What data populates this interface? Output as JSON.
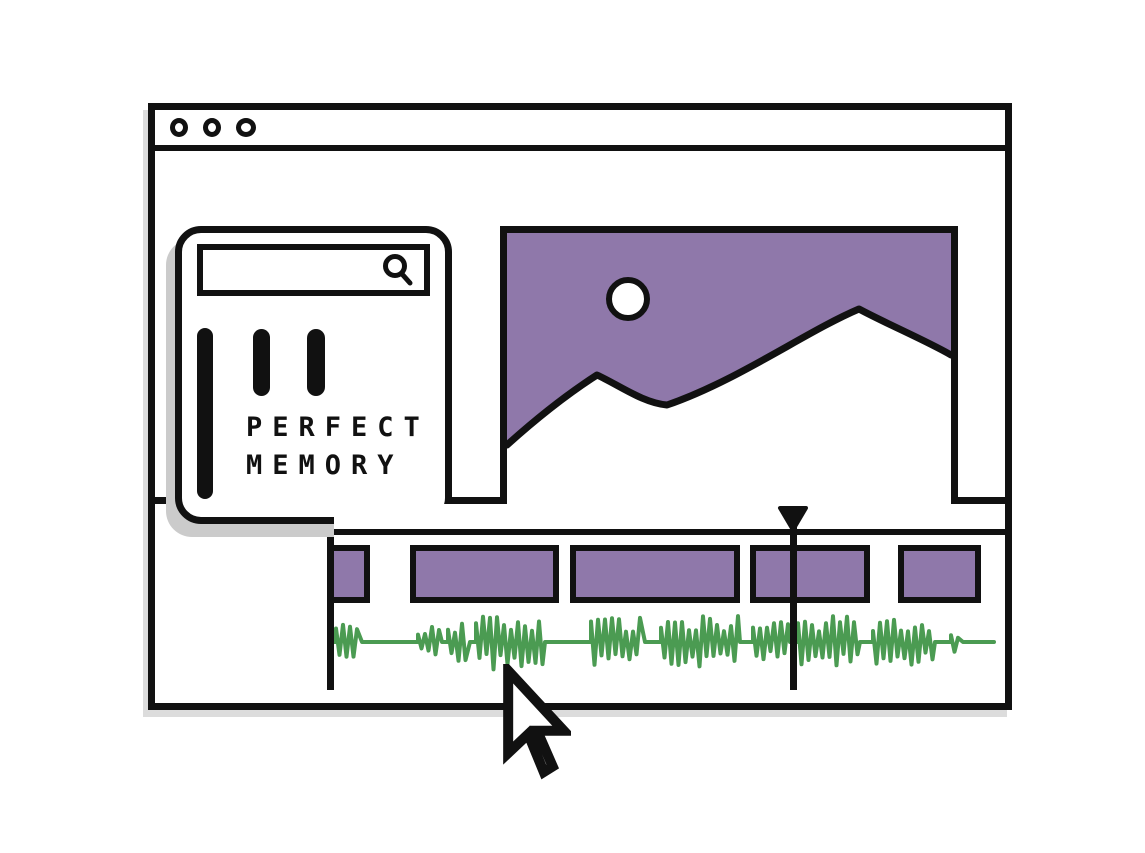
{
  "colors": {
    "ink": "#111111",
    "accent_purple": "#8F78AA",
    "waveform_green": "#4B9B52",
    "shadow_gray": "#CBCBCB"
  },
  "window": {
    "titlebar": {
      "dots": [
        "window-dot",
        "window-dot",
        "window-dot"
      ]
    }
  },
  "sidebar_card": {
    "search": {
      "value": "",
      "placeholder": "",
      "icon": "search-icon"
    },
    "logo_bars": 3,
    "brand": {
      "line1": "PERFECT",
      "line2": "MEMORY"
    }
  },
  "preview": {
    "type": "image-placeholder",
    "elements": [
      "sun",
      "mountain-ridge"
    ]
  },
  "timeline": {
    "clips": [
      {
        "left": 0,
        "width": 36,
        "cropped_left": true
      },
      {
        "left": 76,
        "width": 149,
        "cropped_left": false
      },
      {
        "left": 236,
        "width": 170,
        "cropped_left": false
      },
      {
        "left": 416,
        "width": 120,
        "cropped_left": false
      },
      {
        "left": 564,
        "width": 83,
        "cropped_left": false
      }
    ],
    "playhead": {
      "x": 459
    },
    "waveform": {
      "mid_y": 138,
      "end_x": 660,
      "bursts": [
        [
          2,
          26,
          18
        ],
        [
          84,
          106,
          15
        ],
        [
          114,
          134,
          20
        ],
        [
          142,
          209,
          28
        ],
        [
          257,
          309,
          25
        ],
        [
          327,
          404,
          26
        ],
        [
          419,
          454,
          22
        ],
        [
          464,
          524,
          26
        ],
        [
          539,
          599,
          24
        ],
        [
          617,
          627,
          10
        ]
      ]
    }
  },
  "cursor": {
    "icon": "arrow-pointer",
    "x": 507,
    "y": 670
  }
}
